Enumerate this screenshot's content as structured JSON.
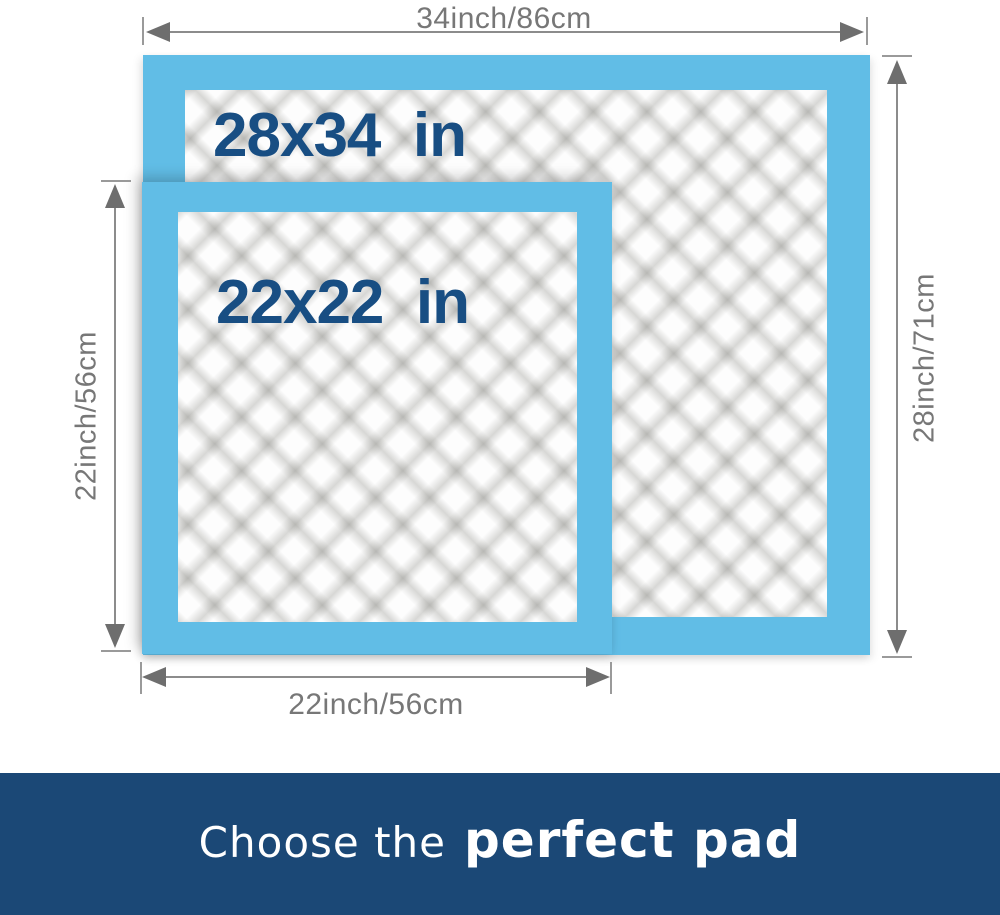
{
  "colors": {
    "pad_blue": "#61BDE6",
    "label_navy": "#184E83",
    "banner_navy": "#1B4876",
    "dim_gray": "#777777"
  },
  "dimensions": {
    "top": "34inch/86cm",
    "right": "28inch/71cm",
    "left": "22inch/56cm",
    "bottom": "22inch/56cm"
  },
  "pads": {
    "large": {
      "label": "28x34  in"
    },
    "small": {
      "label": "22x22  in"
    }
  },
  "banner": {
    "prefix": "Choose the",
    "highlight": "perfect pad"
  }
}
